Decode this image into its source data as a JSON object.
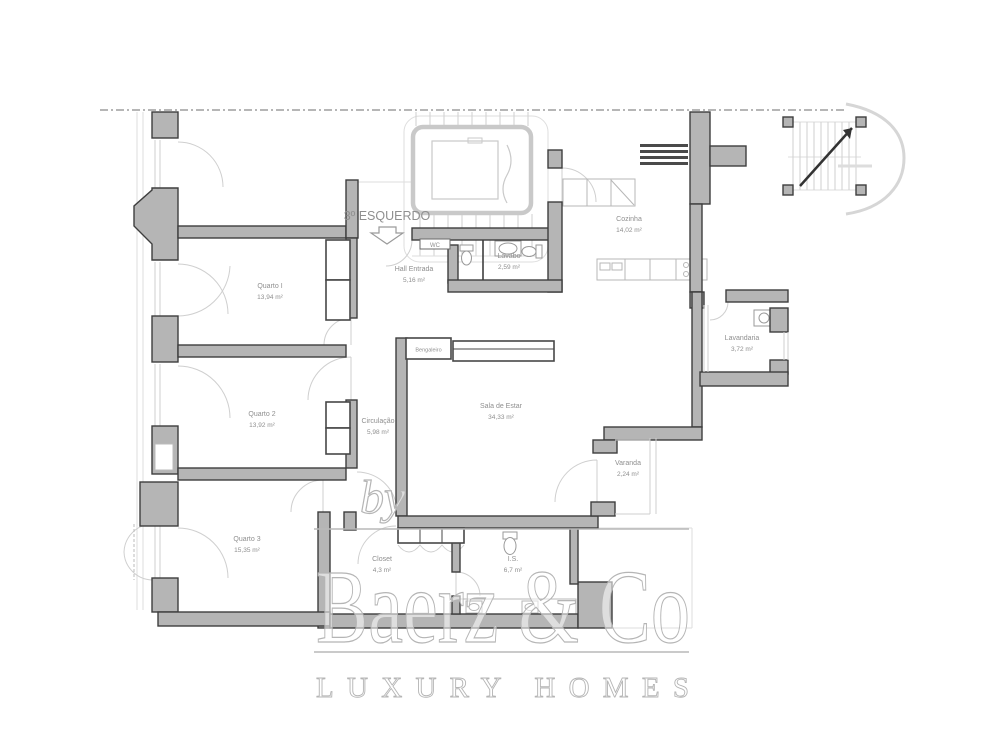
{
  "page": {
    "background": "#ffffff",
    "type": "apartment-floor-plan"
  },
  "floor_label": {
    "text": "3º ESQUERDO"
  },
  "rooms": [
    {
      "id": "quarto1",
      "name": "Quarto I",
      "area": "13,94 m²"
    },
    {
      "id": "quarto2",
      "name": "Quarto 2",
      "area": "13,92 m²"
    },
    {
      "id": "quarto3",
      "name": "Quarto 3",
      "area": "15,35 m²"
    },
    {
      "id": "hall",
      "name": "Hall Entrada",
      "area": "5,16 m²"
    },
    {
      "id": "lavabo",
      "name": "Lavabo",
      "area": "2,59 m²"
    },
    {
      "id": "cozinha",
      "name": "Cozinha",
      "area": "14,02 m²"
    },
    {
      "id": "sala",
      "name": "Sala de Estar",
      "area": "34,33 m²"
    },
    {
      "id": "circulacao",
      "name": "Circulação",
      "area": "5,98 m²"
    },
    {
      "id": "lavandaria",
      "name": "Lavandaria",
      "area": "3,72 m²"
    },
    {
      "id": "varanda",
      "name": "Varanda",
      "area": "2,24 m²"
    },
    {
      "id": "closet",
      "name": "Closet",
      "area": "4,3 m²"
    },
    {
      "id": "is",
      "name": "I.S.",
      "area": "6,7 m²"
    }
  ],
  "small_labels": [
    {
      "id": "bengaleiro",
      "text": "Bengaleiro"
    },
    {
      "id": "wc",
      "text": "WC"
    }
  ],
  "watermark": {
    "prefix": "by",
    "brand": "Baerz & Co",
    "tagline": "LUXURY HOMES"
  },
  "colors": {
    "wall_fill": "#b5b5b5",
    "wall_stroke": "#3e3e3e",
    "detail_line": "#cfcfcf",
    "label_text": "#8f8f8f",
    "watermark": "#b5b5b5",
    "dashed_boundary": "#8a8a8a"
  }
}
